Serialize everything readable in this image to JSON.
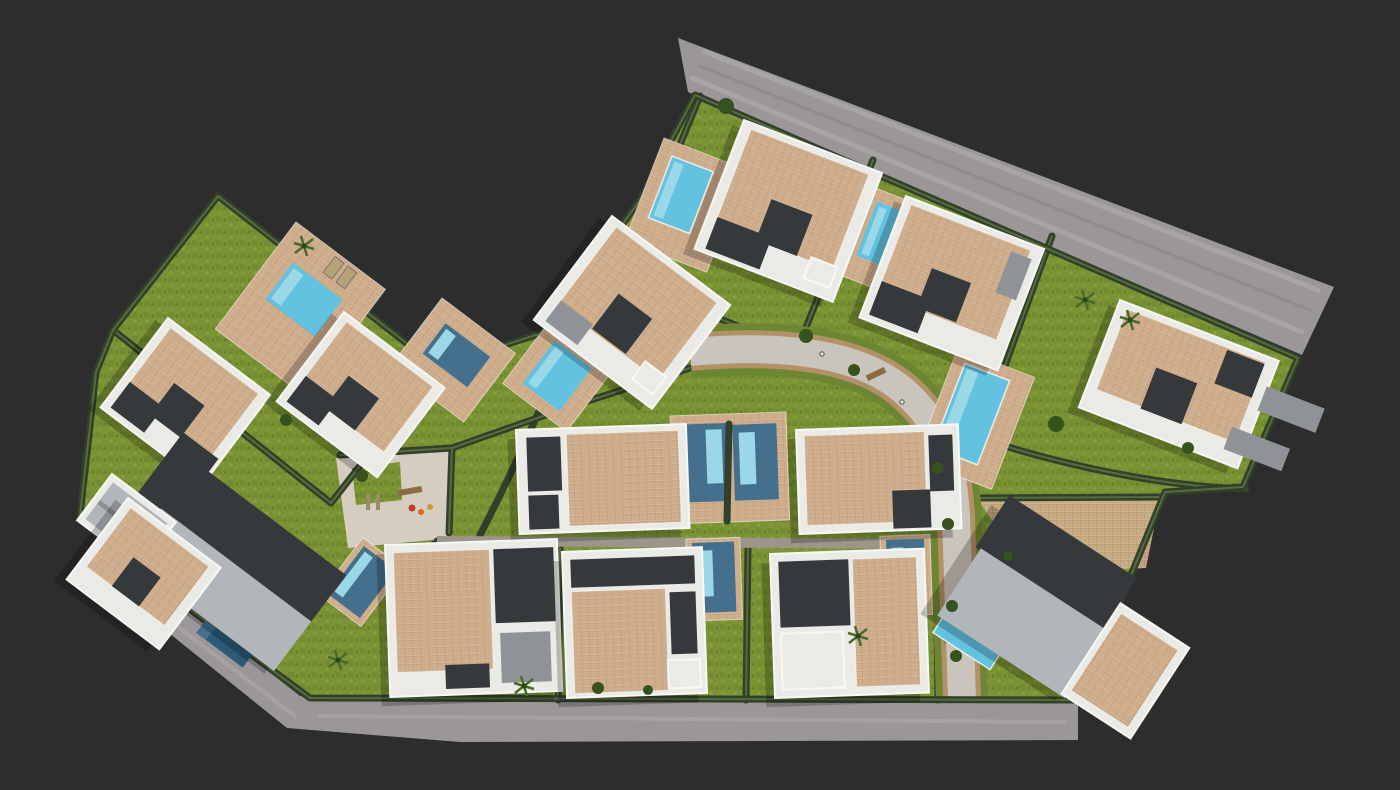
{
  "scene": {
    "type": "aerial-3d-architectural-render",
    "subject": "Top-down bird's-eye 3D visualization of a gated residential villa development",
    "setting": "render floats on a dark charcoal studio background",
    "villa_count": 15,
    "pool_count": 13,
    "features": [
      "perimeter road along the top-right edge",
      "perimeter road along the bottom-left edge",
      "curved internal street with green verges, benches and lamp posts",
      "hedge-bordered private plots with lawns",
      "white modern villas with beige tiled roofs",
      "two houses with dark gabled roofs",
      "private swimming pools",
      "communal paved area with playground",
      "palm trees and round trees"
    ]
  },
  "colors": {
    "background": "#2d2d2d",
    "road": "#9b9798",
    "road_streak_light": "#b6b3b4",
    "road_streak_dark": "#868285",
    "lawn": "#7b9334",
    "lawn_dark": "#5f7829",
    "hedge": "#32402b",
    "hedge_light": "#576c3c",
    "villa_white": "#eaeae6",
    "roof_tile": "#cfae8d",
    "roof_dark": "#36393b",
    "gable_light": "#b1b6bb",
    "gable_mid": "#8f9397",
    "pool_bright": "#62c2e0",
    "pool_light": "#9ad8e8",
    "pool_steel": "#44708e",
    "pool_dark": "#2c5a77",
    "paving": "#c6b096",
    "paving_light": "#d6cdc1",
    "street": "#c9c5bc",
    "street_border": "#b29166",
    "alley": "#9c958b",
    "verge": "#6d8634",
    "tree": "#35521f",
    "palm": "#4a6b2b",
    "bench": "#8a6b42"
  }
}
